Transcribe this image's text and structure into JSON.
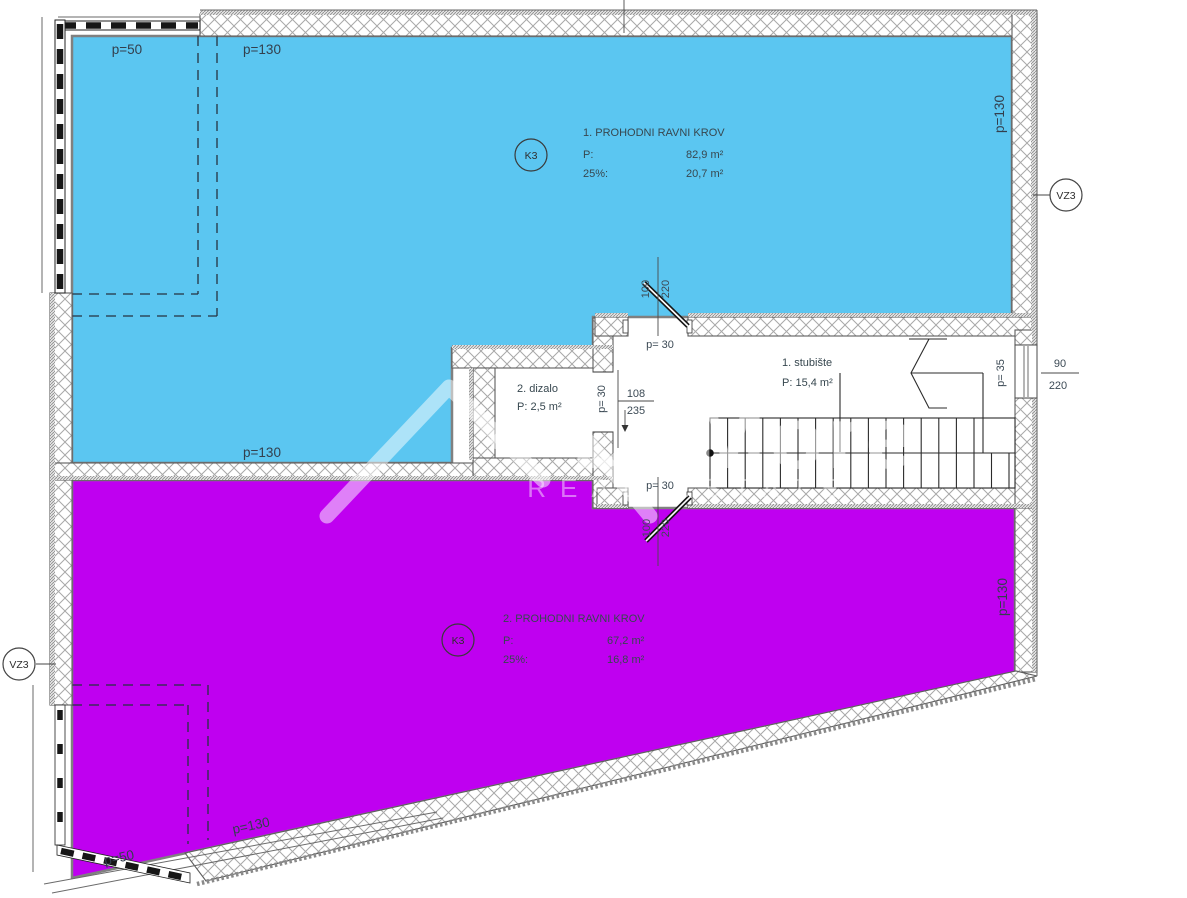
{
  "watermark": {
    "brand": "DeMore",
    "subtitle": "REAL ESTATE"
  },
  "zones": {
    "roof1": {
      "title": "1. PROHODNI RAVNI KROV",
      "area_label": "P:",
      "area_value": "82,9 m²",
      "percent_label": "25%:",
      "percent_value": "20,7 m²",
      "tag": "K3",
      "fill": "#5bc6f1"
    },
    "roof2": {
      "title": "2. PROHODNI RAVNI KROV",
      "area_label": "P:",
      "area_value": "67,2 m²",
      "percent_label": "25%:",
      "percent_value": "16,8 m²",
      "tag": "K3",
      "fill": "#bf00f0"
    },
    "stairs": {
      "title": "1. stubište",
      "area": "P: 15,4 m²"
    },
    "elevator": {
      "title": "2. dizalo",
      "area": "P: 2,5 m²"
    }
  },
  "edge_labels": {
    "p50": "p=50",
    "p130": "p=130",
    "p30": "p= 30",
    "p35": "p= 35"
  },
  "dimensions": {
    "elevator_door": {
      "width": "108",
      "height": "235"
    },
    "upper_door": {
      "width": "100",
      "height": "220"
    },
    "lower_door": {
      "width": "100",
      "height": "220"
    },
    "window": {
      "width": "90",
      "height": "220"
    }
  },
  "markers": {
    "ventilation": "VZ3"
  }
}
